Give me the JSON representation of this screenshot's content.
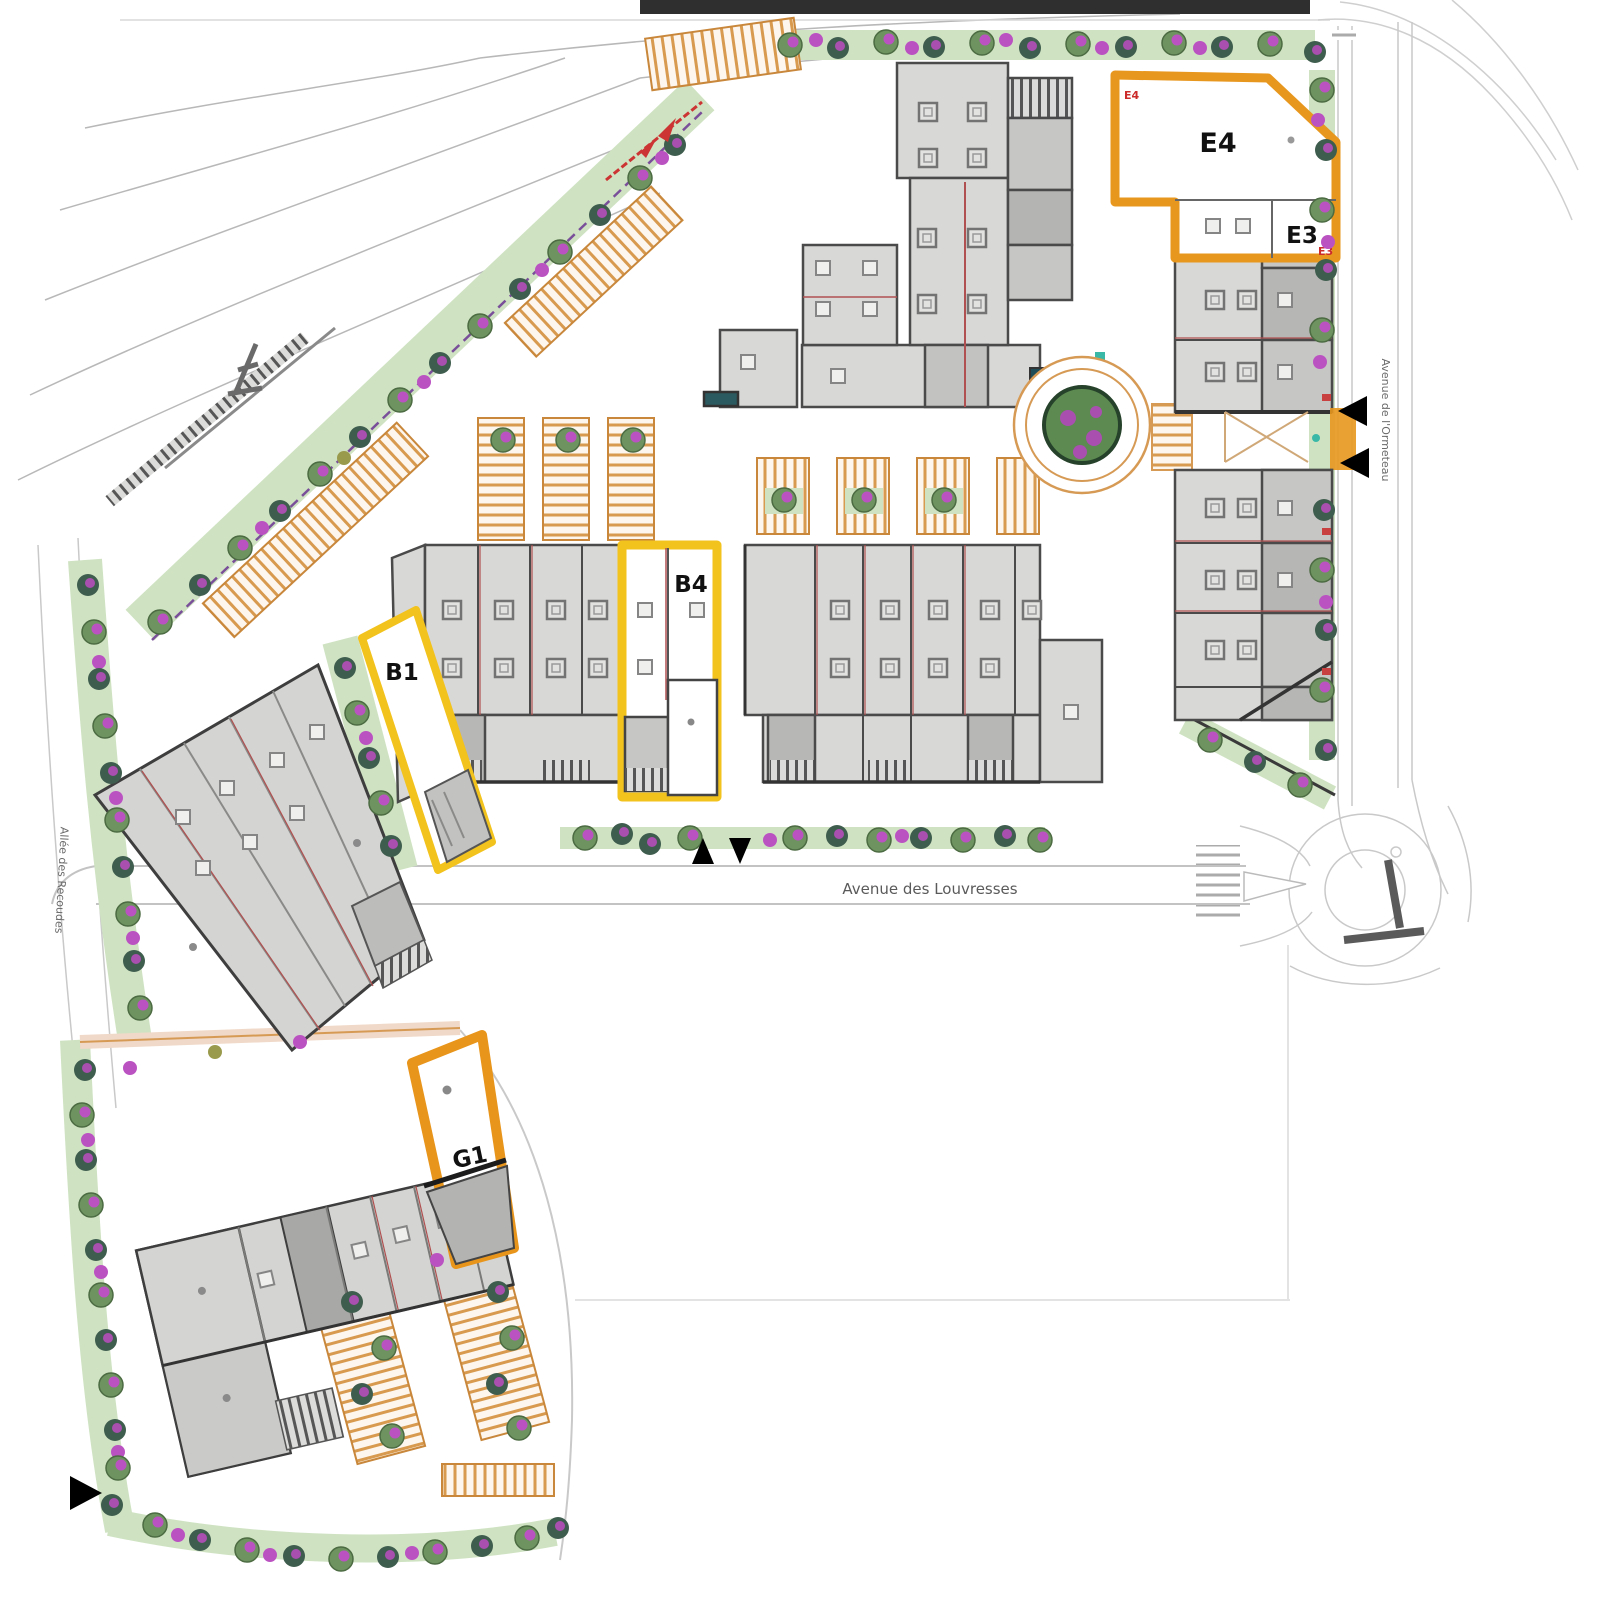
{
  "map": {
    "type": "site-plan",
    "streets": {
      "avenue_des_louvresses": "Avenue des Louvresses",
      "avenue_de_l_ormeteau": "Avenue de l'Ormeteau",
      "allee_des_recoudes": "Allée des Recoudes"
    },
    "highlighted_units": {
      "e4": {
        "label": "E4",
        "tag": "E4",
        "outline": "#E8971E"
      },
      "e3": {
        "label": "E3",
        "tag": "E3",
        "outline": "#E8971E"
      },
      "b4": {
        "label": "B4",
        "outline": "#F2C21D"
      },
      "b1": {
        "label": "B1",
        "outline": "#F2C21D"
      },
      "g1": {
        "label": "G1",
        "outline": "#E8951C"
      }
    },
    "colors": {
      "building_fill": "#D6D6D4",
      "building_stroke": "#4A4A4A",
      "green_belt": "#CFE3C2",
      "tree_foliage": "#6E9360",
      "tree_accent": "#BB52C2",
      "parking_hatch": "#D89A4E",
      "highlight_orange": "#E8971E",
      "highlight_yellow": "#F2C21D",
      "section_line_red": "#CC3333"
    }
  }
}
